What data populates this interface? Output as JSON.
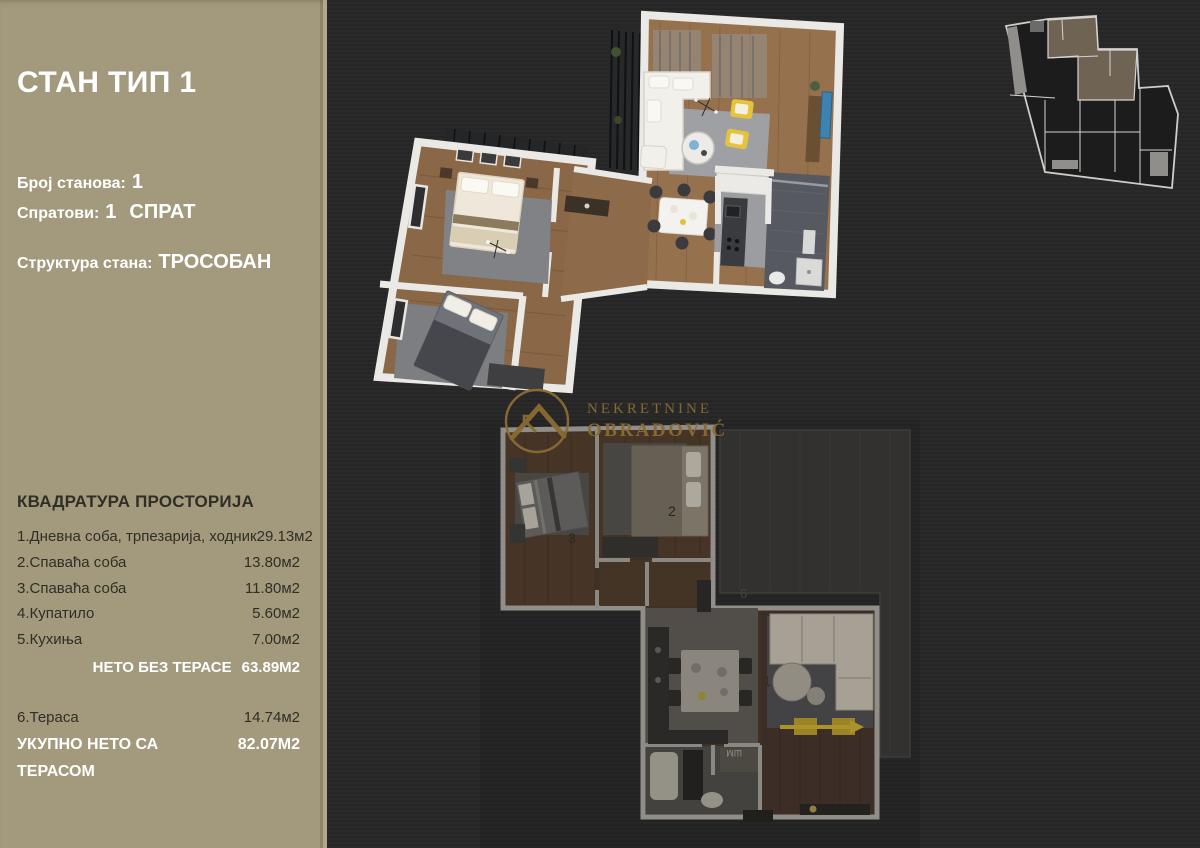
{
  "colors": {
    "sidebar_bg": "#a39a7d",
    "page_bg": "#272727",
    "accent_gold": "#8a6b33",
    "text_light": "#ffffff",
    "text_dark": "#2f2e27",
    "accent_yellow": "#e5c33c"
  },
  "sidebar": {
    "title": "СТАН ТИП 1",
    "apartments_label": "Број станова:",
    "apartments_value": "1",
    "floors_label": "Спратови:",
    "floors_value": "1",
    "floors_suffix": "СПРАТ",
    "structure_label": "Структура стана:",
    "structure_value": "ТРОСОБАН",
    "areas": {
      "heading": "КВАДРАТУРА ПРОСТОРИЈА",
      "rooms": [
        {
          "name": "1.Дневна соба, трпезарија, ходник",
          "area": "29.13м2"
        },
        {
          "name": "2.Спаваћа соба",
          "area": "13.80м2"
        },
        {
          "name": "3.Спаваћа соба",
          "area": "11.80м2"
        },
        {
          "name": "4.Купатило",
          "area": "5.60м2"
        },
        {
          "name": "5.Кухиња",
          "area": "7.00м2"
        }
      ],
      "net_label": "НЕТО БЕЗ ТЕРАСЕ",
      "net_value": "63.89М2",
      "terrace_name": "6.Тераса",
      "terrace_area": "14.74м2",
      "total_label": "УКУПНО НЕТО СА ТЕРАСОМ",
      "total_value": "82.07М2"
    }
  },
  "logo": {
    "line1": "NEKRETNINE",
    "line2": "OBRADOVIĆ"
  },
  "plans": {
    "lower": {
      "labels": [
        {
          "text": "1"
        },
        {
          "text": "2"
        },
        {
          "text": "3"
        },
        {
          "text": "6"
        },
        {
          "text": "ШМ"
        }
      ]
    }
  }
}
